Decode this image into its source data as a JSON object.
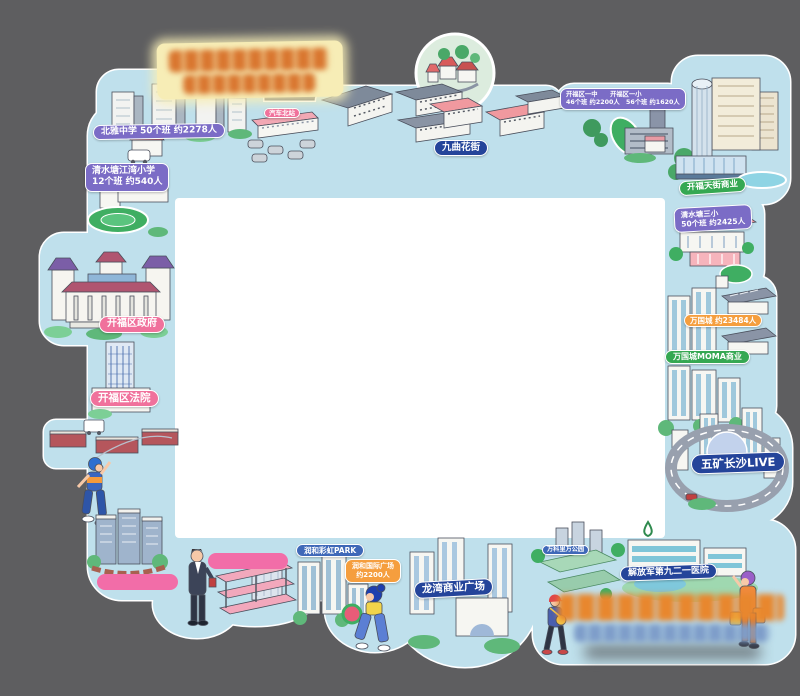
{
  "poster": {
    "type": "illustrated-district-map-frame",
    "title_block": {
      "legible": false,
      "bg": "#f7edb6",
      "text_color": "#d9762f"
    },
    "footer_block": {
      "legible": false,
      "line1_color": "#e8872e",
      "line2_color": "#7d9cc9"
    },
    "colors": {
      "background": "#5e5e60",
      "frame": "#bfe0ec",
      "center": "#ffffff",
      "badge_purple": "#7b6cc6",
      "badge_pink": "#f0719c",
      "badge_navy": "#24449a",
      "badge_blue": "#3f68b8",
      "badge_green": "#35a852",
      "badge_orange": "#f59e3e",
      "blank_bar_pink": "#f26da8",
      "medallion": "#dcecde"
    }
  },
  "badges": {
    "beiya": "北雅中学 50个班 约2278人",
    "jiangwan_l1": "清水塘江湾小学",
    "jiangwan_l2": "12个班 约540人",
    "bus_north": "汽车北站",
    "jiuqu": "九曲花街",
    "schools_l1": "开福区一中　　开福区一小",
    "schools_l2": "46个班 约2200人　56个班 约1620人",
    "tianjie": "开福天街商业",
    "qst3_l1": "清水塘三小",
    "qst3_l2": "50个班 约2425人",
    "wanguocheng": "万国城 约23484人",
    "moma": "万国城MOMA商业",
    "wukuang": "五矿长沙LIVE",
    "gov": "开福区政府",
    "court": "开福区法院",
    "hospital": "解放军第九二一医院",
    "wanke_park": "万科里万公园",
    "longwan": "龙湾商业广场",
    "runhe_rainbow": "润和彩虹PARK",
    "runhe_intl_l1": "润和国际广场",
    "runhe_intl_l2": "约2200人"
  }
}
